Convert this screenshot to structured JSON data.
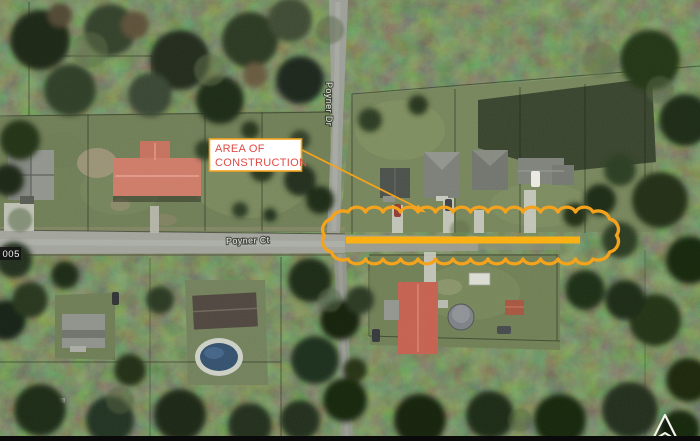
{
  "annotation": {
    "label_line1": "AREA OF",
    "label_line2": "CONSTRUCTION"
  },
  "streets": {
    "horizontal_street": "Poyner Ct",
    "vertical_street": "Poyner Dr"
  },
  "parcel_edge_label": "005",
  "icons": {
    "north_arrow_icon": "▲"
  },
  "colors": {
    "annotation_orange": "#F5A31D",
    "construction_line_yellow": "#FBB114",
    "label_text_red": "#E14B45",
    "label_box_bg": "#FFFFFF",
    "road_gray": "#A1A39B",
    "forest_dark_green": "#2C3A23",
    "lawn_green": "#75845A",
    "red_roof": "#C4604F",
    "pool_blue": "#33506D",
    "frame_black": "#0A0A0A"
  }
}
